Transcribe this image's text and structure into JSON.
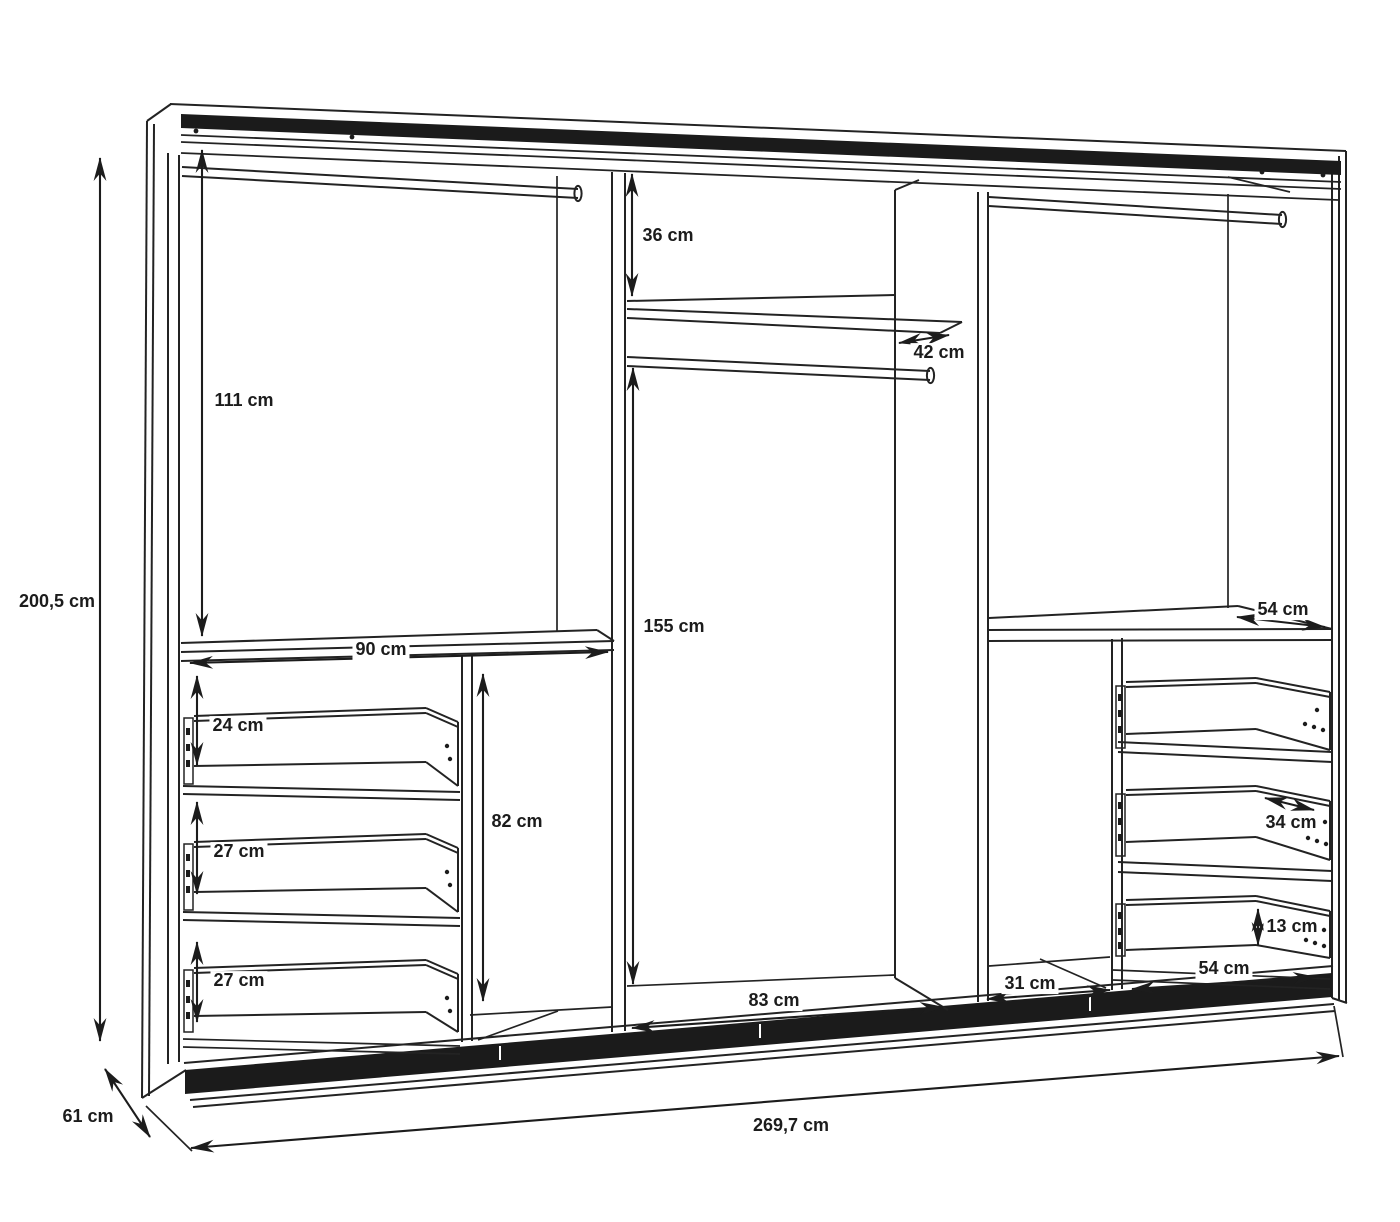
{
  "diagram": {
    "kind": "wardrobe-interior-dimension-drawing",
    "unit": "cm",
    "colors": {
      "background": "#ffffff",
      "line": "#222222",
      "track": "#1b1b1b"
    },
    "overall": {
      "height": "200,5 cm",
      "width": "269,7 cm",
      "depth": "61 cm"
    },
    "labels": {
      "overall_height": "200,5 cm",
      "overall_width": "269,7 cm",
      "overall_depth": "61 cm",
      "left_hanging_height": "111 cm",
      "left_shelf_width": "90 cm",
      "left_drawer_1_height": "24 cm",
      "left_drawer_2_height": "27 cm",
      "left_drawer_3_height": "27 cm",
      "left_open_compartment_height": "82 cm",
      "middle_top_gap_height": "36 cm",
      "middle_shelf_depth": "42 cm",
      "middle_hanging_height": "155 cm",
      "middle_width": "83 cm",
      "right_shelf_depth": "54 cm",
      "right_drawer_depth": "34 cm",
      "right_drawer_height": "13 cm",
      "right_drawer_width": "54 cm",
      "right_open_compartment_width": "31 cm"
    }
  }
}
